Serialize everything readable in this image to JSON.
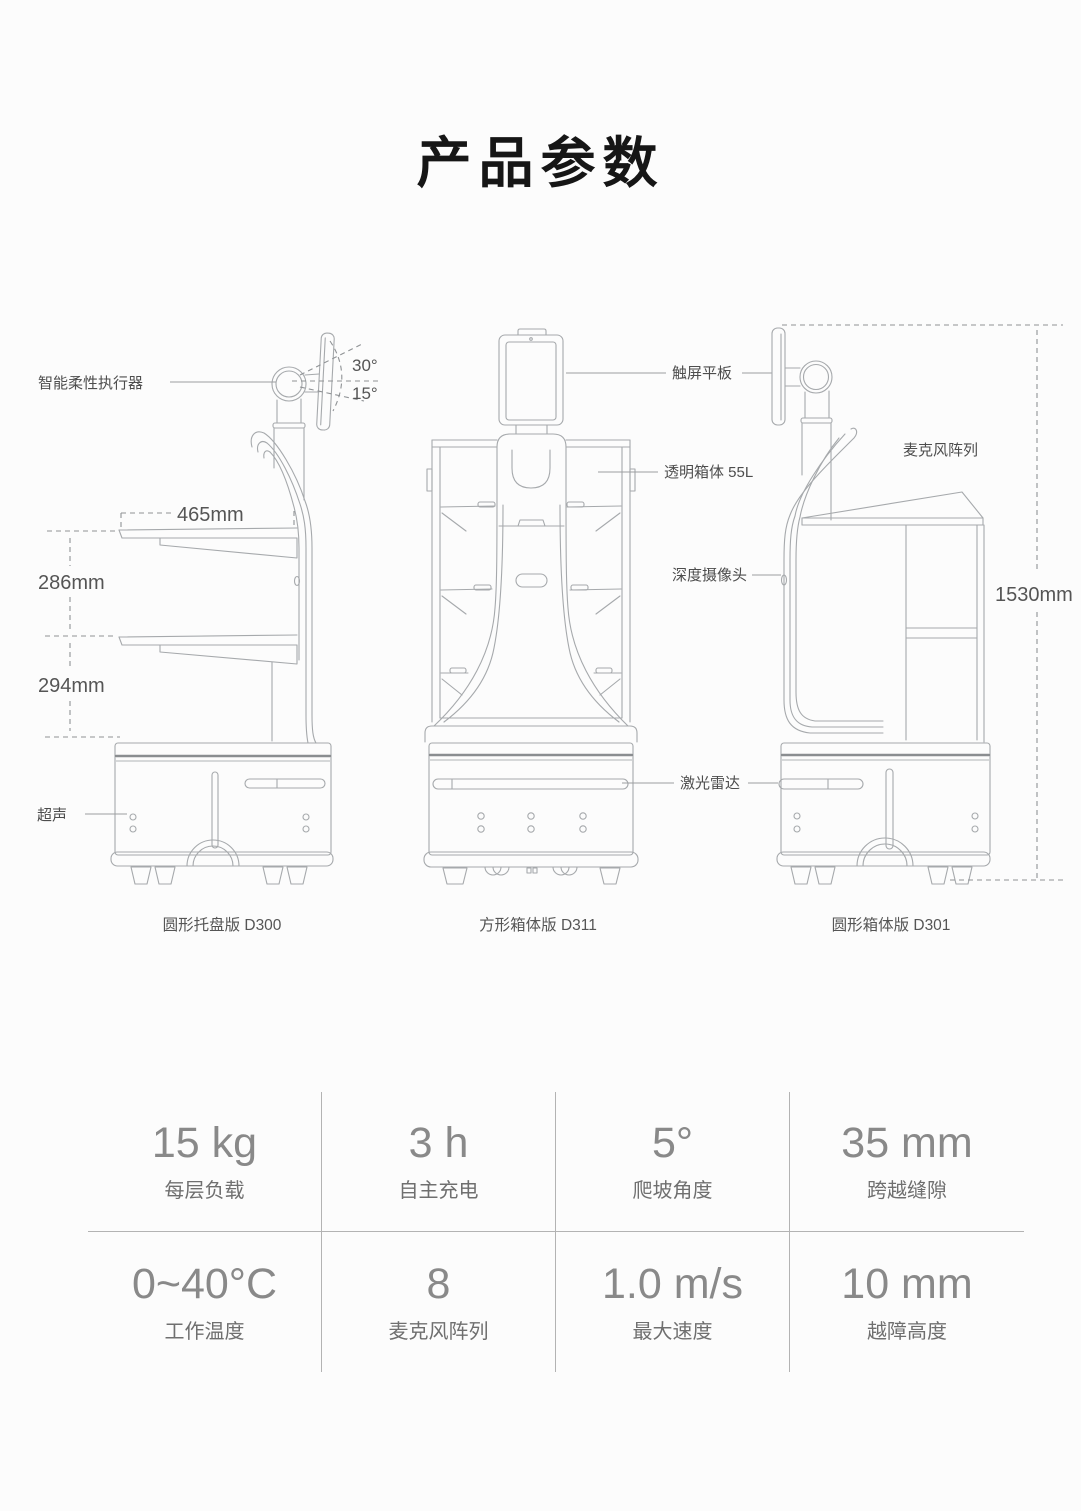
{
  "page": {
    "title": "产品参数"
  },
  "diagram": {
    "labels": {
      "actuator": "智能柔性执行器",
      "angle_up": "30°",
      "angle_down": "15°",
      "dim_width": "465mm",
      "dim_tray1": "286mm",
      "dim_tray2": "294mm",
      "ultrasonic": "超声",
      "touchscreen": "触屏平板",
      "transparent_box": "透明箱体 55L",
      "depth_camera": "深度摄像头",
      "lidar": "激光雷达",
      "mic_array": "麦克风阵列",
      "dim_height": "1530mm"
    },
    "captions": {
      "left": "圆形托盘版 D300",
      "middle": "方形箱体版 D311",
      "right": "圆形箱体版 D301"
    }
  },
  "specs": {
    "rows": [
      [
        {
          "value": "15 kg",
          "label": "每层负载"
        },
        {
          "value": "3 h",
          "label": "自主充电"
        },
        {
          "value": "5°",
          "label": "爬坡角度"
        },
        {
          "value": "35 mm",
          "label": "跨越缝隙"
        }
      ],
      [
        {
          "value": "0~40°C",
          "label": "工作温度"
        },
        {
          "value": "8",
          "label": "麦克风阵列"
        },
        {
          "value": "1.0 m/s",
          "label": "最大速度"
        },
        {
          "value": "10 mm",
          "label": "越障高度"
        }
      ]
    ]
  }
}
